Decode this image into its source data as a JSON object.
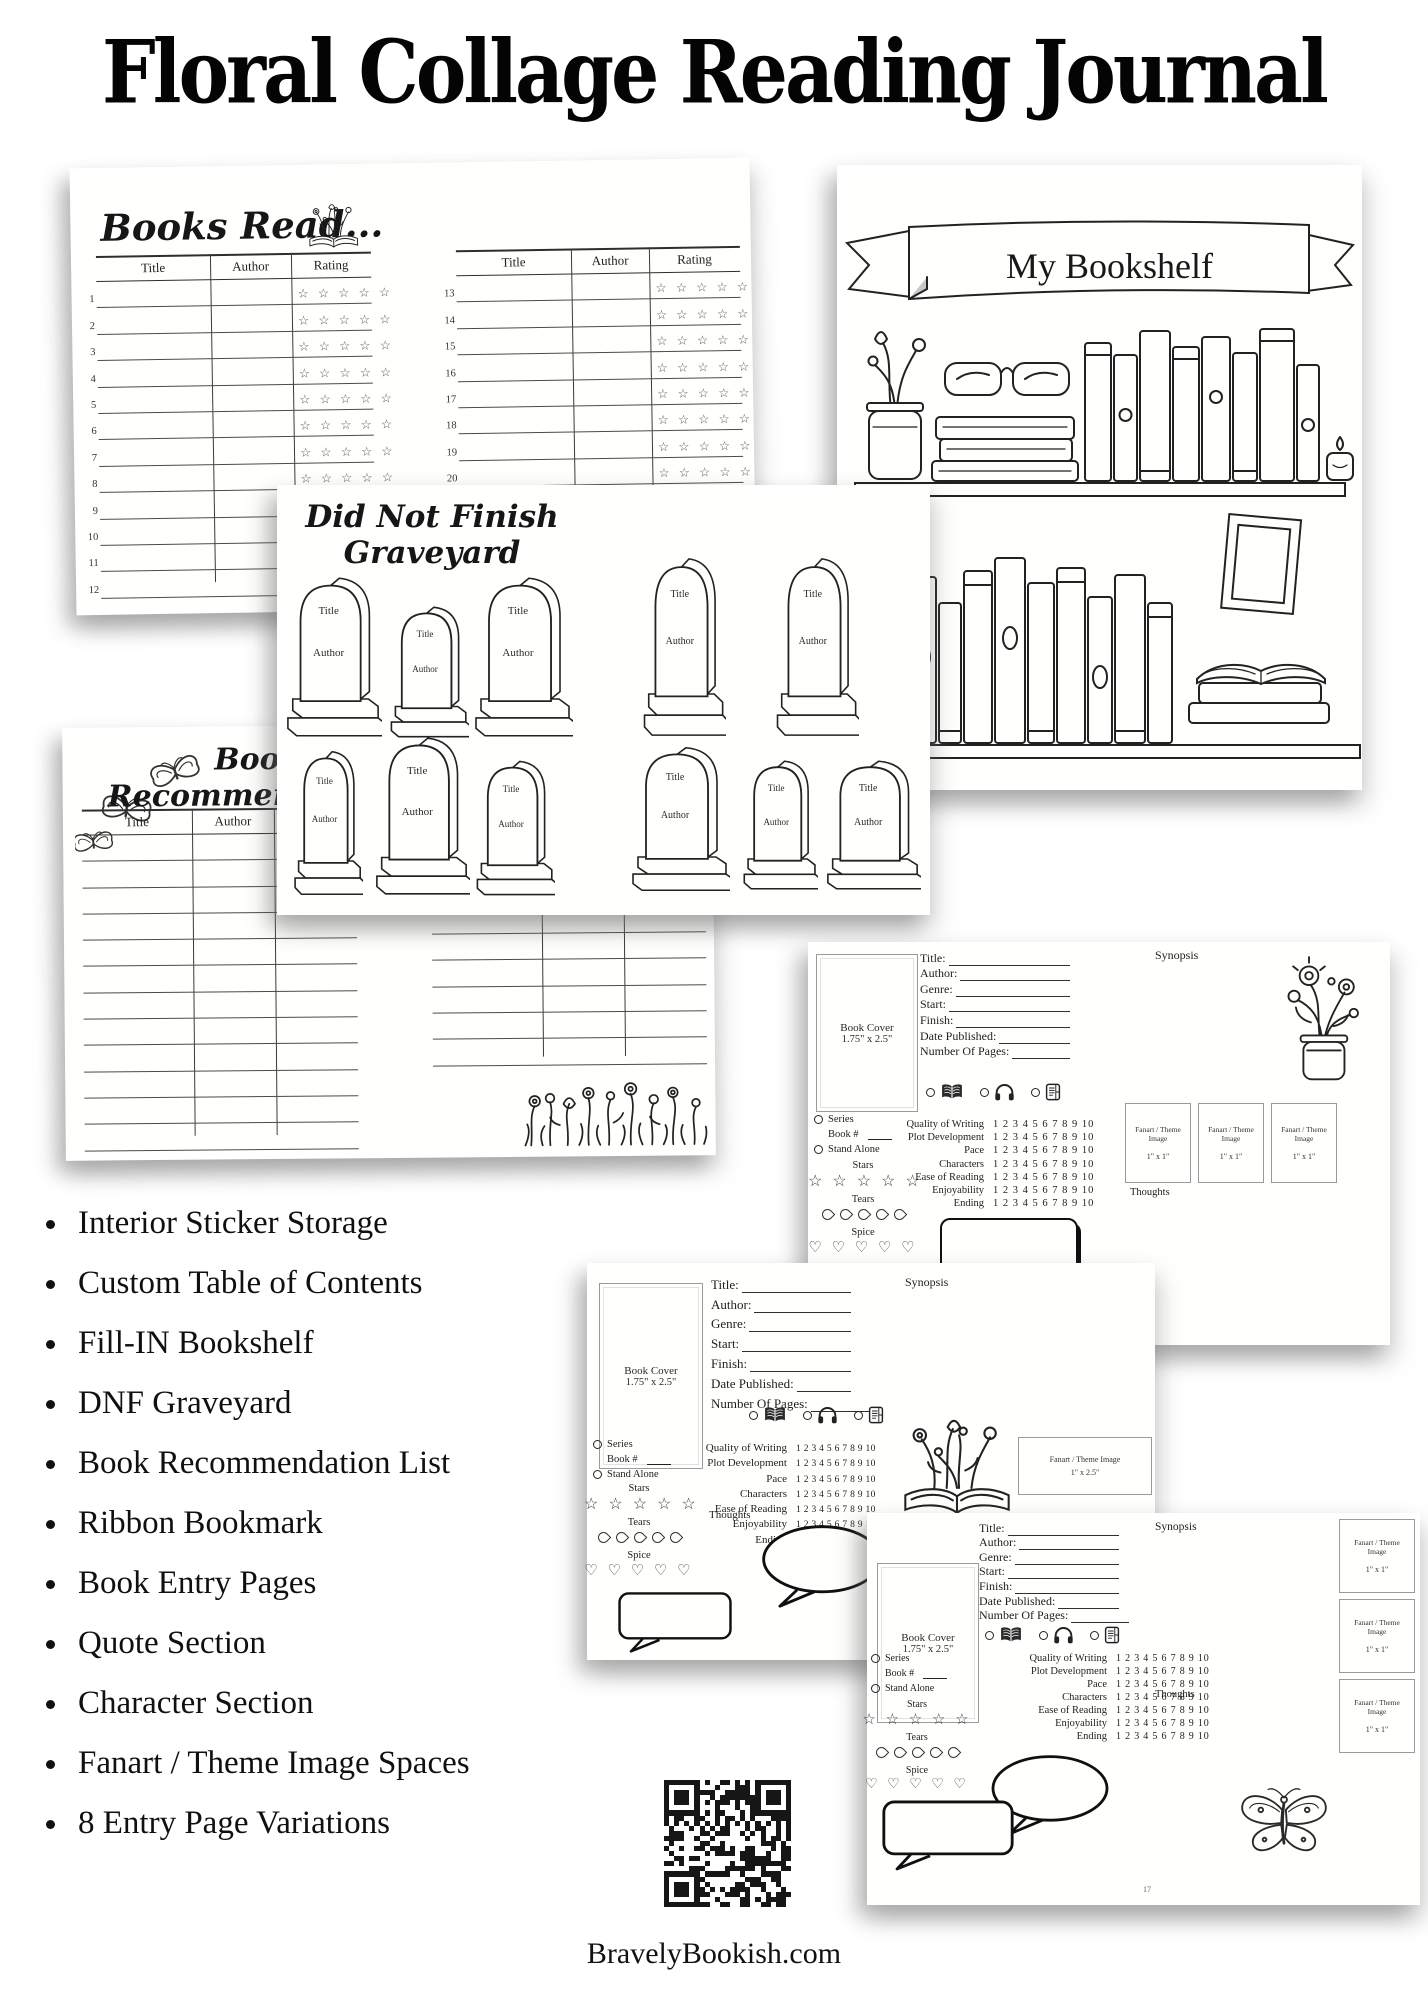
{
  "poster": {
    "title": "Floral Collage Reading Journal",
    "website": "BravelyBookish.com"
  },
  "colors": {
    "ink": "#1e1e1e",
    "table_line": "#4a4a4a",
    "page_bg": "#fffffd"
  },
  "books_read": {
    "title": "Books Read...",
    "columns": [
      "Title",
      "Author",
      "Rating"
    ],
    "left_row_start": 1,
    "left_row_count": 12,
    "right_row_start": 13,
    "right_row_count": 12,
    "stars_per_row": 5,
    "star_icon": "☆"
  },
  "bookshelf": {
    "banner": "My Bookshelf"
  },
  "graveyard": {
    "title_line1": "Did Not Finish",
    "title_line2": "Graveyard",
    "stone_title": "Title",
    "stone_author": "Author"
  },
  "recommendation": {
    "title_line1": "Book",
    "title_line2": "Recommendations",
    "columns": [
      "Title",
      "Author"
    ],
    "left_row_count": 12,
    "right_row_count": 9
  },
  "entry": {
    "cover_label": "Book Cover",
    "cover_size": "1.75\" x 2.5\"",
    "fields": [
      "Title:",
      "Author:",
      "Genre:",
      "Start:",
      "Finish:",
      "Date Published:",
      "Number Of Pages:"
    ],
    "synopsis": "Synopsis",
    "thoughts": "Thoughts",
    "series": "Series",
    "book_no": "Book #",
    "stand_alone": "Stand Alone",
    "stars_label": "Stars",
    "tears_label": "Tears",
    "spice_label": "Spice",
    "format_icons": [
      "physical-book",
      "audiobook",
      "ebook"
    ],
    "ratings": [
      "Quality of Writing",
      "Plot Development",
      "Pace",
      "Characters",
      "Ease of Reading",
      "Enjoyability",
      "Ending"
    ],
    "scale": "1 2 3 4 5 6 7 8 9 10",
    "fanart_label": "Fanart / Theme Image",
    "fanart_size_small": "1\" x 1\"",
    "fanart_size_wide": "1\" x 2.5\"",
    "page_numbers": [
      "12",
      "15",
      "17"
    ],
    "star_icon": "☆",
    "heart_icon": "♡"
  },
  "features": [
    "Interior Sticker Storage",
    "Custom Table of Contents",
    "Fill-IN Bookshelf",
    "DNF Graveyard",
    "Book Recommendation List",
    "Ribbon Bookmark",
    "Book Entry Pages",
    "Quote Section",
    "Character Section",
    "Fanart / Theme Image Spaces",
    "8 Entry Page Variations"
  ]
}
